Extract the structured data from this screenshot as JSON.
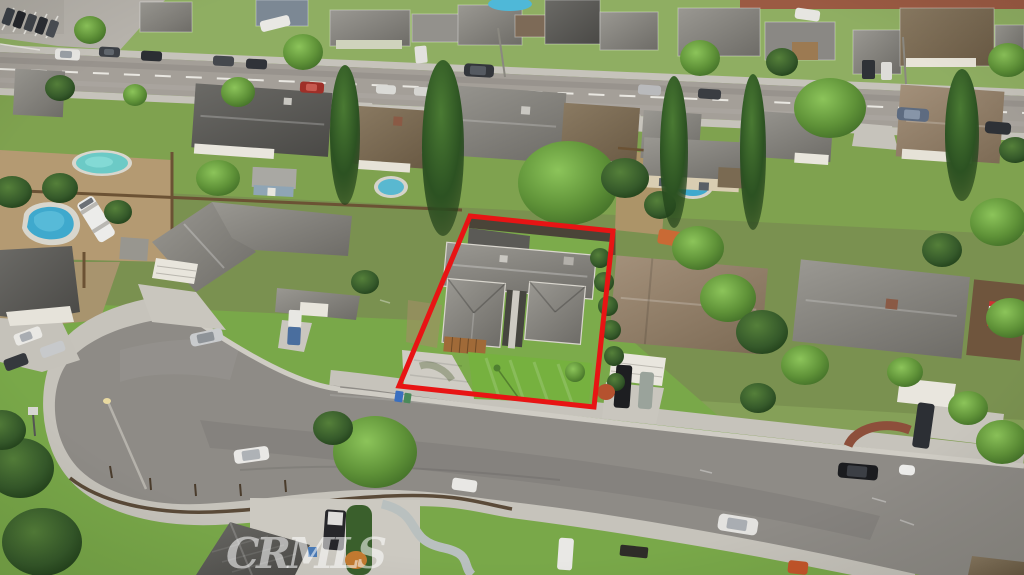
{
  "watermark": {
    "label": "CRMLS"
  },
  "boundary": {
    "kind": "subject-property-outline",
    "points": "470,216 613,231 594,407 399,386",
    "color": "#e81414",
    "stroke_width": 5
  },
  "palette": {
    "asphalt_main_road": "#a49f98",
    "asphalt_street": "#8e8b86",
    "concrete": "#cbc8c0",
    "sidewalk": "#c6c3bb",
    "lawn_bright": "#74ab44",
    "lawn_mid": "#7fa24f",
    "backyard_grass": "#7a9150",
    "dirt": "#b49a72",
    "roof_gray": "#8b8984",
    "roof_dark": "#4e4e50",
    "roof_brown": "#7c6c56",
    "roof_tan": "#93826a",
    "tree_dark": "#2f5b26",
    "tree_light": "#6fae3e",
    "pool_aqua": "#6ccac6",
    "pool_blue": "#3fa9cd",
    "red_outline": "#e81414",
    "watermark_color": "rgba(255,255,255,0.55)"
  }
}
